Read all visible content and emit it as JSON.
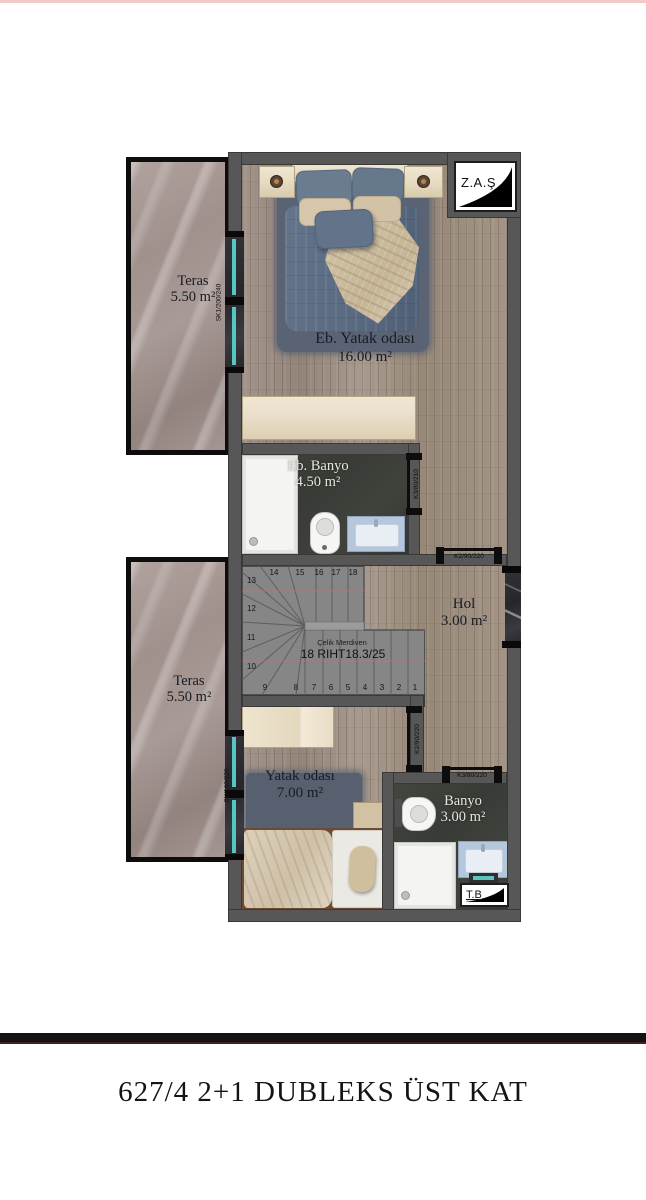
{
  "page": {
    "title": "627/4 2+1 DUBLEKS ÜST KAT"
  },
  "logos": {
    "zas": "Z.A.Ş",
    "tb": "T.B"
  },
  "rooms": {
    "master_bedroom": {
      "name": "Eb. Yatak odası",
      "area": "16.00 m²"
    },
    "master_bath": {
      "name": "Eb. Banyo",
      "area": "4.50 m²"
    },
    "hall": {
      "name": "Hol",
      "area": "3.00 m²"
    },
    "bedroom": {
      "name": "Yatak odası",
      "area": "7.00 m²"
    },
    "bath": {
      "name": "Banyo",
      "area": "3.00 m²"
    },
    "terrace_upper": {
      "name": "Teras",
      "area": "5.50 m²"
    },
    "terrace_lower": {
      "name": "Teras",
      "area": "5.50 m²"
    }
  },
  "stairs": {
    "material_label": "Çelik Merdiven",
    "spec_label": "18 RIHT18.3/25",
    "numbers": [
      "1",
      "2",
      "3",
      "4",
      "5",
      "6",
      "7",
      "8",
      "9",
      "10",
      "11",
      "12",
      "13",
      "14",
      "15",
      "16",
      "17",
      "18"
    ]
  },
  "windows": {
    "upper": "SK1/200/240",
    "lower": "SK/160/220"
  },
  "doors": {
    "master_bath_door": "K3/80/210",
    "hall_door": "K2/90/220",
    "bedroom_door": "K2/90/220",
    "bath_door": "K3/80/220"
  },
  "colors": {
    "wall_gray": "#575757",
    "glass_teal": "#55c6c0",
    "wood_floor": "#9c8e80",
    "marble": "#a39693",
    "dark_bath_floor": "#3c3f3a",
    "rug_blue": "#5a6373",
    "accent_pink_line": "#f2caca"
  }
}
